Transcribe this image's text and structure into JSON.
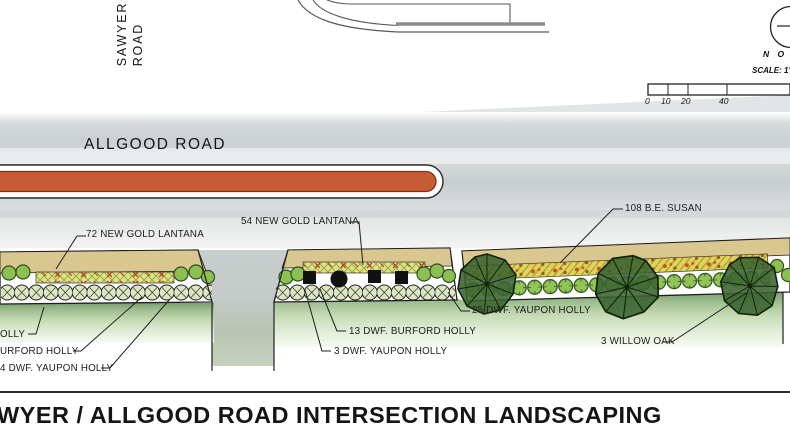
{
  "title": "WYER / ALLGOOD ROAD INTERSECTION LANDSCAPING",
  "roads": {
    "sawyer_line1": "SAWYER",
    "sawyer_line2": "ROAD",
    "allgood": "ALLGOOD ROAD"
  },
  "compass": {
    "north_label": "N O R"
  },
  "scalebar": {
    "label": "SCALE: 1\"",
    "ticks": [
      "0",
      "10",
      "20",
      "40"
    ]
  },
  "plant_labels": {
    "lantana_72": "72 NEW GOLD LANTANA",
    "lantana_54": "54 NEW GOLD LANTANA",
    "susan_108": "108 B.E. SUSAN",
    "yaupon_25": "25 DWF. YAUPON HOLLY",
    "burford_13": "13 DWF. BURFORD HOLLY",
    "yaupon_3": "3 DWF. YAUPON HOLLY",
    "willow_oak_3": "3 WILLOW OAK",
    "cut_holly": "OLLY",
    "cut_burford_holly": "URFORD HOLLY",
    "cut_yaupon_holly": "4 DWF. YAUPON HOLLY"
  },
  "colors": {
    "median_fill": "#c75b33",
    "road_surface": "#ccd2d4",
    "sidewalk_tan": "#dac68f",
    "lantana_bed": "#e0e188",
    "susan_bed": "#e2d257",
    "holly_green": "#90c455",
    "tree_green": "#3a6330",
    "grass_green": "#9fbe90"
  }
}
